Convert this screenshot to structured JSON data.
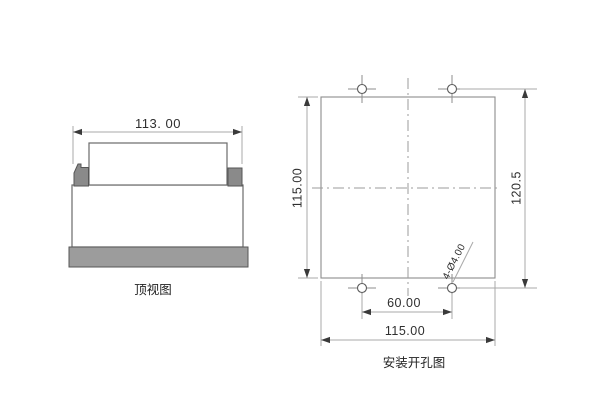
{
  "colors": {
    "background": "#ffffff",
    "object_line": "#6a6a6a",
    "panel_line": "#8d8d8d",
    "dim_line": "#a8a8a8",
    "centerline": "#9b9b9b",
    "text": "#2f2f2f",
    "panel_gray": "#9c9c9c",
    "clip_gray": "#8a8a8a",
    "arrow": "#3a3a3a"
  },
  "top_view": {
    "label": "顶视图",
    "width_dimension": "113. 00"
  },
  "mounting_view": {
    "label": "安装开孔图",
    "panel_height_dimension": "115.00",
    "hole_vertical_span_dimension": "120.5",
    "hole_horizontal_span_dimension": "60.00",
    "panel_width_dimension": "115.00",
    "hole_callout": "4-Ø4.00"
  }
}
